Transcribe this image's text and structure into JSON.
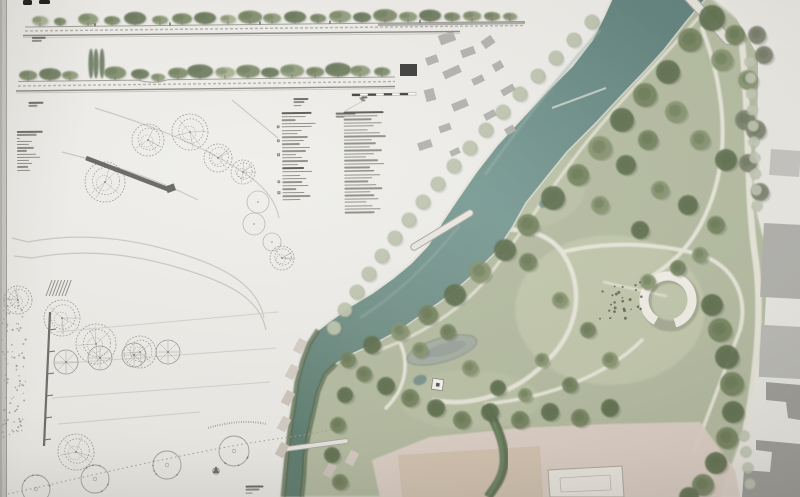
{
  "palette": {
    "paper": "#efeeea",
    "board_edge": "#c9c8c5",
    "board_seam": "#a39f9a",
    "river_dark": "#63847f",
    "river_mid": "#7a9c96",
    "river_light": "#8fa8a0",
    "channel_veg": "#55684c",
    "stream_dark": "#4f6347",
    "park_base": "#b6bea3",
    "meadow_light": "#c8cdb2",
    "tree_tones": [
      "#5f7050",
      "#74845f",
      "#87956f",
      "#a2ad8a",
      "#7b816f"
    ],
    "tree_pale": "#bfc7b1",
    "building_gray": "#b3b3af",
    "building_dark_gray": "#a09f9b",
    "building_black": "#3c3c3a",
    "plaza_pink": "#e3d5cc",
    "building_tan": "#d6c5b1",
    "path_cream": "#edebe0",
    "bank_line": "#eceae2",
    "pond_fill": "#a8b1a7",
    "ring_white": "#f3f1ea",
    "ink_dark": "#55534e",
    "ink_light": "#8d8b85",
    "pencil": "#a9a7a2",
    "section_ground": "#a09e98",
    "scalebar_dark": "#3f3f3b"
  },
  "header_tabs": {
    "count": 2,
    "color": "#151515"
  },
  "legend": {
    "x": 283,
    "y": 111,
    "col2_offset": 62,
    "col1_rows": [
      30,
      24,
      14,
      34,
      30,
      20,
      16,
      26,
      22,
      18,
      28,
      24,
      14,
      20,
      26,
      16,
      22,
      30,
      18,
      24,
      20,
      26,
      14,
      22,
      28,
      18
    ],
    "col1_headers": [
      0,
      16
    ],
    "col1_symbols": {
      "4": "circle",
      "8": "circle",
      "12": "square",
      "20": "circle",
      "23": "square"
    },
    "col2_rows": [
      40,
      34,
      28,
      38,
      30,
      24,
      36,
      42,
      28,
      32,
      26,
      38,
      30,
      22,
      34,
      40,
      26,
      30,
      36,
      28,
      24,
      32,
      38,
      26,
      30,
      34,
      22,
      28,
      36,
      30
    ],
    "col2_headers": [
      0,
      17
    ]
  },
  "microtext_blocks": [
    {
      "name": "section-a-caption",
      "x": 34,
      "y": 33,
      "widths": [
        14,
        10
      ]
    },
    {
      "name": "section-b-caption",
      "x": 30,
      "y": 98,
      "widths": [
        15,
        9
      ]
    },
    {
      "name": "scale-note",
      "x": 295,
      "y": 97,
      "widths": [
        15,
        11,
        8
      ]
    },
    {
      "name": "scale-figures",
      "x": 363,
      "y": 96,
      "widths": [
        6,
        4
      ]
    },
    {
      "name": "legend-leader-note",
      "x": 337,
      "y": 112,
      "widths": [
        20,
        9
      ]
    },
    {
      "name": "plan1-key-notes",
      "x": 18,
      "y": 127,
      "widths": [
        26,
        20,
        3,
        15,
        12,
        17,
        10,
        19,
        23,
        12,
        15,
        11,
        13
      ]
    },
    {
      "name": "plan2-caption",
      "x": 243,
      "y": 484,
      "widths": [
        18,
        14,
        7
      ]
    }
  ]
}
